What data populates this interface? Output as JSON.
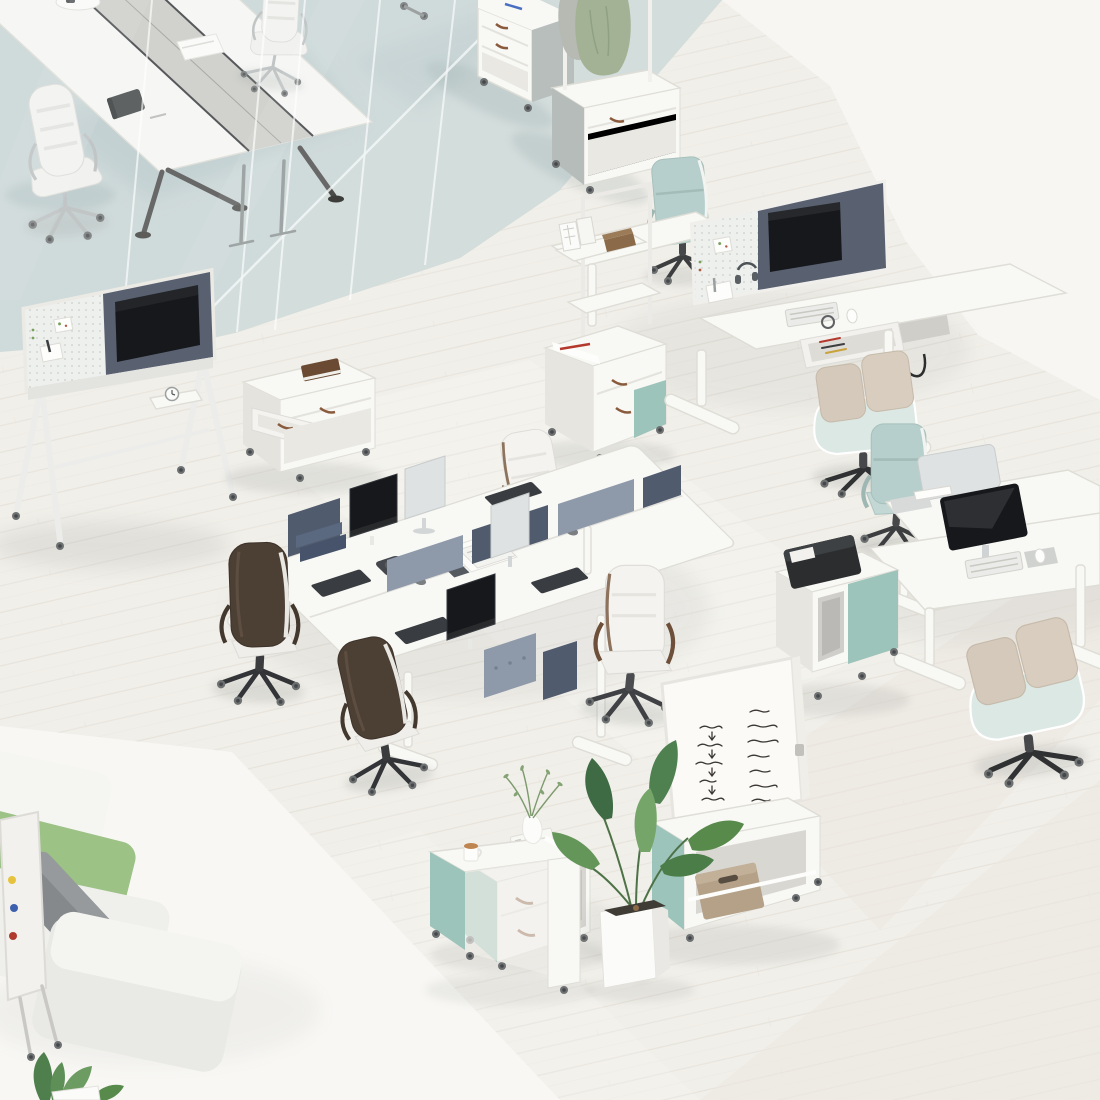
{
  "meta": {
    "description": "Isometric 3D rendering of a modern office interior furniture collection with sit-stand desks, bench workstations, mobile storage carts, whiteboards, lounge sofa and plants",
    "visible_text_present": false
  },
  "palette": {
    "floor": "#f1efe9",
    "plank": "#e3dfd7",
    "whiteZone": "#f7f6f3",
    "rug": "#f8f7f4",
    "carpet": "#c9d5d5",
    "carpetLight": "#d3dddc",
    "carpetShadow": "#adc0c2",
    "furnWhite": "#f8f8f5",
    "furnEdge": "#deddd6",
    "teal": "#9dc4ba",
    "feltDark": "#505b6e",
    "feltMid": "#8e99aa",
    "feltPanel": "#596171",
    "monitorBack": "#dfe2e2",
    "screen": "#16181b",
    "green": "#9cc286",
    "greyBlock": "#83878a",
    "beige": "#d4c9ba",
    "mint": "#dce8e4",
    "tealChair": "#b7cfcc",
    "brownLeather": "#8a5a3c",
    "darkBrown": "#4c3f34",
    "chrome": "#b7bbbc",
    "black": "#2a2c2e",
    "plantGreen": "#4f8050",
    "shadow": "#8e938f",
    "handwriting": "#3a3734",
    "woodBook": "#6b4a33",
    "tan": "#b4a188",
    "red": "#b3392c",
    "blue": "#4a6fc2"
  },
  "scene": {
    "objects": {
      "floor": {
        "label": "light wood plank office floor"
      },
      "white_zone": {
        "label": "white floor area, top right"
      },
      "rug": {
        "label": "white lounge rug, bottom left"
      },
      "carpet": {
        "label": "blue-grey carpet, meeting zone"
      },
      "glass_partition": {
        "label": "glass partition wall of meeting room with door handles"
      },
      "conference_table": {
        "label": "white conference table with grey cable channel, notebook and papers"
      },
      "conference_chairs": {
        "label": "white and chrome executive meeting chairs"
      },
      "storage_cart_a": {
        "label": "white mobile drawer cart on carpet"
      },
      "coat_rack_cart": {
        "label": "mobile storage cart with coat rack, green and grey coats"
      },
      "tv_stand": {
        "label": "mobile A-frame media stand with pegboard, felt panel and TV screen"
      },
      "drawer_cart": {
        "label": "white mobile cart with open drawer and brown book"
      },
      "shelf_unit": {
        "label": "white pole shelf unit with box files and brown box"
      },
      "shelf_cart": {
        "label": "storage cart with teal end panel, papers and red pen"
      },
      "desk_pair_1": {
        "label": "back-to-back sit-stand desks with pegboard and felt screen, monitor, keyboard, open pencil drawer"
      },
      "teal_chair_1": {
        "label": "teal task chair at far sit-stand desk"
      },
      "beige_chair_1": {
        "label": "beige lounge task chair at near sit-stand desk"
      },
      "bench_cluster": {
        "label": "four-person bench desk cluster with felt dividers and monitors"
      },
      "bench_chairs": {
        "label": "four leather conference chairs in white and dark brown"
      },
      "desk_pair_2": {
        "label": "second pair of back-to-back sit-stand desks with two monitors"
      },
      "teal_chair_2": {
        "label": "teal task chair at second desk pair"
      },
      "beige_chair_2": {
        "label": "beige lounge task chair at second desk pair"
      },
      "printer_cart": {
        "label": "storage cart with black printer on top"
      },
      "whiteboard_cart": {
        "label": "mobile cabinet with large whiteboard and tan storage box"
      },
      "storage_cart_b": {
        "label": "teal-sided cabinet with drawers and white boxes on top"
      },
      "sofa": {
        "label": "modular lounge sofa with white, green and grey cushions"
      },
      "flipchart": {
        "label": "flipchart board seen edge-on with colored magnets"
      },
      "side_table": {
        "label": "white side table cart with coffee mug and vase"
      },
      "plant_large": {
        "label": "potted green plant in white planter"
      },
      "plant_small": {
        "label": "small plant at bottom left corner"
      }
    },
    "whiteboard_notes": {
      "handwriting_legible": false,
      "note_columns": 2,
      "arrow_marks": true
    },
    "flipchart_magnet_colors": [
      "yellow",
      "blue",
      "red"
    ],
    "counts": {
      "office_chairs": 11,
      "desks": 6,
      "conference_tables": 1,
      "storage_carts": 8,
      "mobile_boards": 3,
      "plants": 3,
      "sofas": 1
    }
  }
}
